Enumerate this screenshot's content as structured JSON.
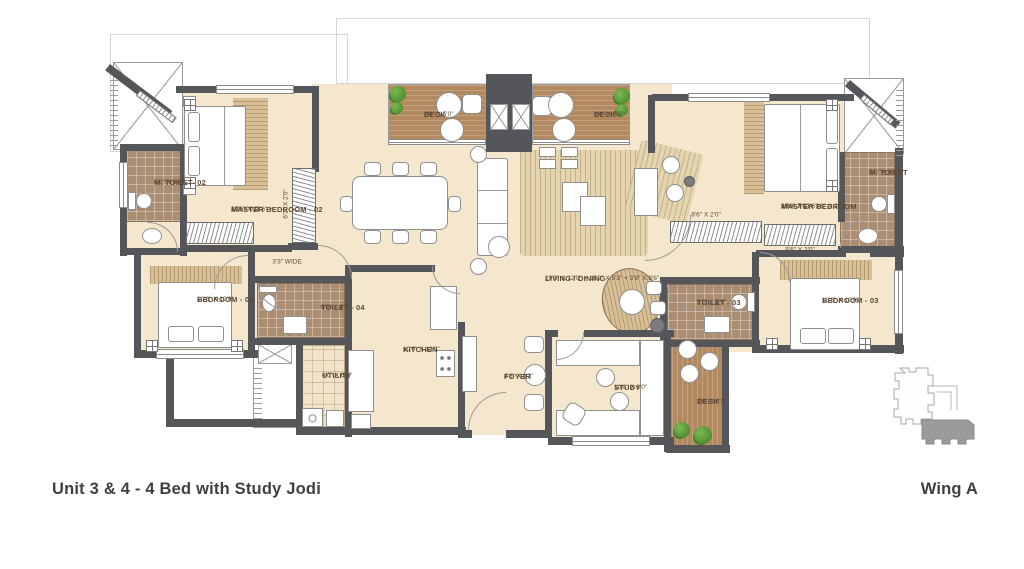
{
  "captions": {
    "unit": "Unit 3 & 4 - 4 Bed with Study Jodi",
    "wing": "Wing A"
  },
  "rooms": [
    {
      "name": "M. TOILET- 02",
      "dims": [
        "5'0\" X 8'0\""
      ]
    },
    {
      "name": "MASTER BEDROOM - 02",
      "dims": [
        "10'6\" X 11'6\" +",
        "3'7\" X 2'0\""
      ]
    },
    {
      "name": "DECK",
      "dims": [
        "9'0\" X 5'0\""
      ]
    },
    {
      "name": "DECK",
      "dims": [
        "9'0\" X 5'0\""
      ]
    },
    {
      "name": "MASTER BEDROOM",
      "dims": [
        "10'6\" X 11'6\" +",
        "8'6 X 7'0\" + 3'3\" X 2'0\""
      ]
    },
    {
      "name": "M. TOILET",
      "dims": [
        "5'0\" X 8'0\""
      ]
    },
    {
      "name": "BEDROOM - 04",
      "dims": [
        "10'6\" X 10'0\""
      ]
    },
    {
      "name": "TOILET - 04",
      "dims": [
        "8'0\" X 5'0\""
      ]
    },
    {
      "name": "KITCHEN",
      "dims": [
        "10'0\" X 13'3\""
      ]
    },
    {
      "name": "UTILITY",
      "dims": [
        "4'0\" X 8'0\""
      ]
    },
    {
      "name": "FOYER",
      "dims": [
        "8'6\" X 8'3\""
      ]
    },
    {
      "name": "LIVING / DINING",
      "dims": [
        "29'0\" X 12'9\" + 15'9\" X 5'3\" + 3'9\" X 8'6\""
      ]
    },
    {
      "name": "STUDY",
      "dims": [
        "10'0\" X 8'0\""
      ]
    },
    {
      "name": "DECK",
      "dims": [
        "4'0\" X 8'0\""
      ]
    },
    {
      "name": "TOILET - 03",
      "dims": [
        "8'0\" X 5'0\""
      ]
    },
    {
      "name": "BEDROOM - 03",
      "dims": [
        "10'6\" X 10'0\""
      ]
    }
  ],
  "annotations": [
    {
      "text": "6'6\" X 2'0\""
    },
    {
      "text": "6'3\" X 2'0\""
    },
    {
      "text": "3'3\" WIDE"
    },
    {
      "text": "8'6\" X 2'0\""
    },
    {
      "text": "8'6\" X 2'0\""
    }
  ],
  "colors": {
    "wall": "#55565a",
    "floor": "#f4e7cd",
    "deck_wood": "#b3895f",
    "toilet_tile": "#ab8d71",
    "plant_green": "#5f9e3e",
    "keyplan_gray": "#9b9b9b",
    "label_text": "#5d4936"
  }
}
